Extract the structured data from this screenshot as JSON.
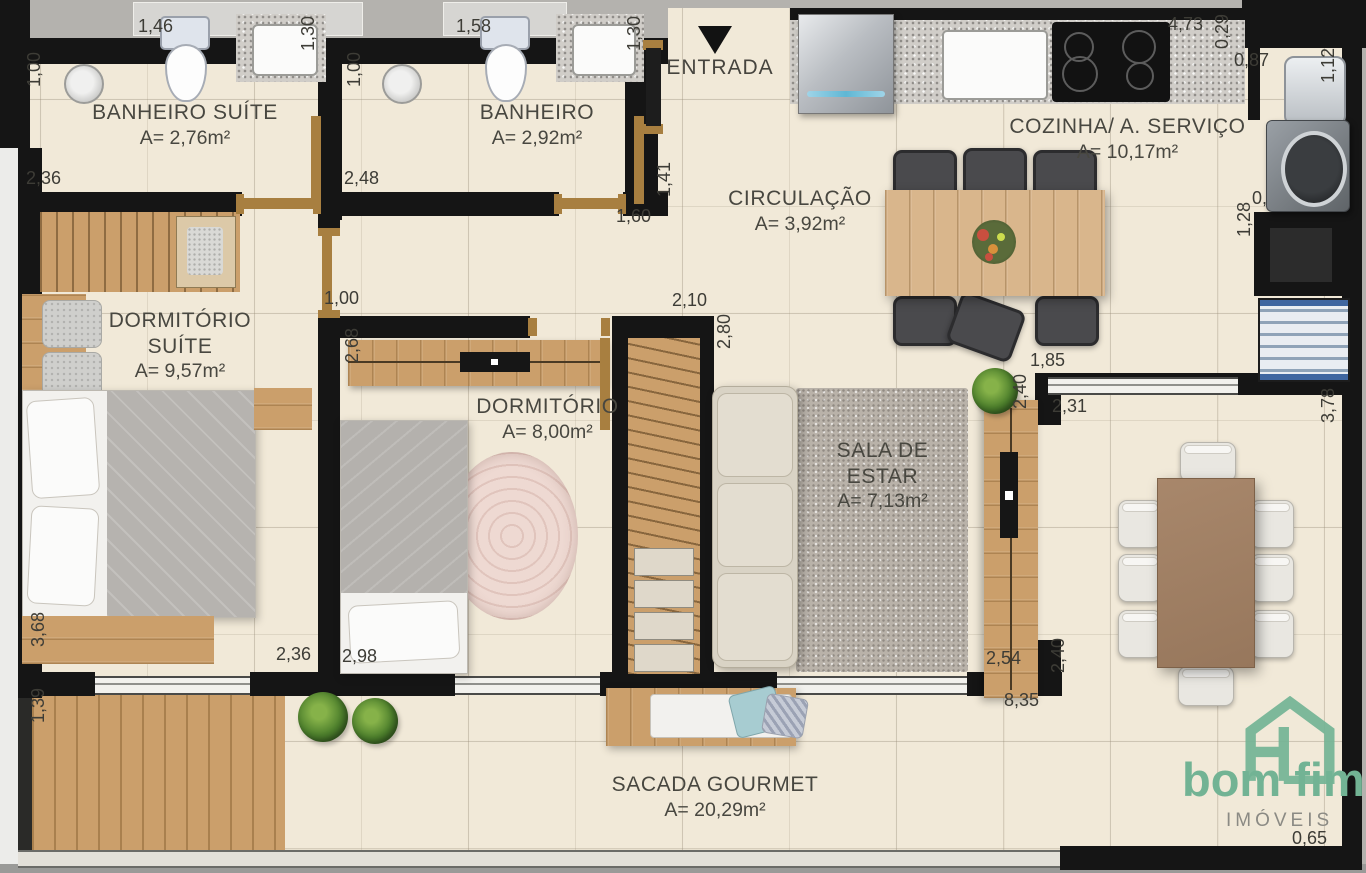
{
  "rooms": {
    "banheiro_suite": {
      "name": "BANHEIRO SUÍTE",
      "area": "A= 2,76m²"
    },
    "banheiro": {
      "name": "BANHEIRO",
      "area": "A= 2,92m²"
    },
    "circulacao": {
      "name": "CIRCULAÇÃO",
      "area": "A= 3,92m²"
    },
    "cozinha": {
      "name": "COZINHA/ A. SERVIÇO",
      "area": "A= 10,17m²"
    },
    "dormitorio_suite": {
      "name": "DORMITÓRIO SUÍTE",
      "area": "A= 9,57m²"
    },
    "dormitorio": {
      "name": "DORMITÓRIO",
      "area": "A= 8,00m²"
    },
    "sala": {
      "name": "SALA DE ESTAR",
      "area": "A= 7,13m²"
    },
    "sacada": {
      "name": "SACADA GOURMET",
      "area": "A= 20,29m²"
    }
  },
  "entrance": {
    "label": "ENTRADA"
  },
  "dimensions": {
    "banheiro_suite_left": "1,00",
    "banheiro_suite_top": "1,46",
    "banheiro_suite_right": "1,30",
    "banheiro_suite_bottom": "2,36",
    "banheiro_left": "1,00",
    "banheiro_top": "1,58",
    "banheiro_right": "1,30",
    "banheiro_bottom": "2,48",
    "hall_right": "1,41",
    "hall_bottom": "1,60",
    "cozinha_top": "4,73",
    "cozinha_corner": "0,29",
    "laundry_width": "0,87",
    "laundry_right": "1,12",
    "washer_width": "0,71",
    "shaft_height": "1,28",
    "dormitorio_top": "1,00",
    "dormitorio_left": "2,68",
    "closet_top": "2,10",
    "closet_right": "2,80",
    "janela_sala": "1,85",
    "pier_top": "2,40",
    "dining_top": "2,31",
    "dining_right": "3,78",
    "sala_bottom": "2,54",
    "pier_bottom": "2,40",
    "sacada_bottom": "8,35",
    "suite_left": "3,68",
    "sacada_left": "1,39",
    "suite_bottom": "2,36",
    "dormitorio_bottom": "2,98",
    "sacada_right": "0,65"
  },
  "logo": {
    "brand": "bom fim",
    "subtitle": "IMÓVEIS"
  },
  "colors": {
    "wall": "#151515",
    "floor": "#f1e9d8",
    "wood": "#cb9f6b",
    "logo_green": "#72b394"
  }
}
